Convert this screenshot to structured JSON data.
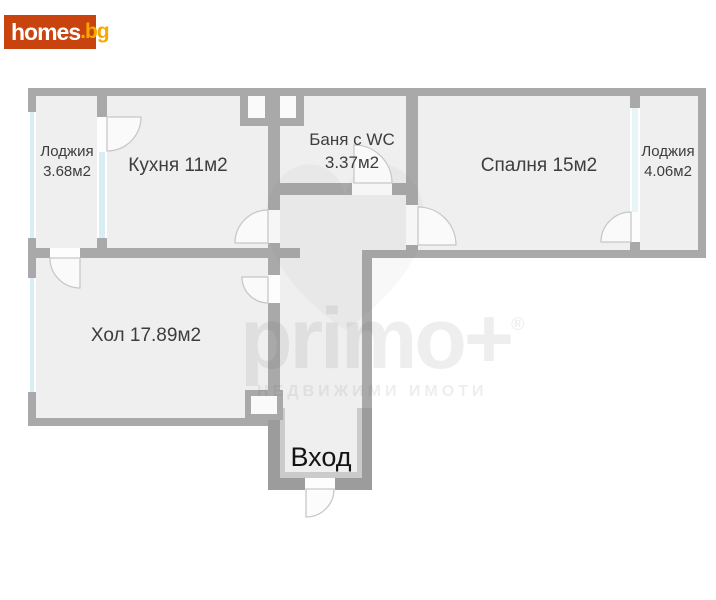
{
  "brand": {
    "name": "homes",
    "tld": ".bg",
    "background_color": "#c8430e",
    "name_color": "#ffffff",
    "tld_color": "#f6a800"
  },
  "watermark": {
    "logo": "primo+",
    "registered": "®",
    "slogan": "НЕДВИЖИМИ ИМОТИ"
  },
  "floorplan": {
    "rooms": {
      "loggia_left": {
        "name": "Лоджия",
        "area": "3.68м2"
      },
      "kitchen": {
        "label": "Кухня 11м2"
      },
      "bathroom": {
        "name": "Баня с WC",
        "area": "3.37м2"
      },
      "bedroom": {
        "label": "Спалня 15м2"
      },
      "loggia_right": {
        "name": "Лоджия",
        "area": "4.06м2"
      },
      "living_room": {
        "label": "Хол 17.89м2"
      },
      "entrance": {
        "label": "Вход"
      }
    },
    "colors": {
      "wall": "#a9a9a9",
      "room_fill": "#efefef",
      "window": "#d9edf4",
      "door_arc_stroke": "#c8c8c8"
    }
  }
}
